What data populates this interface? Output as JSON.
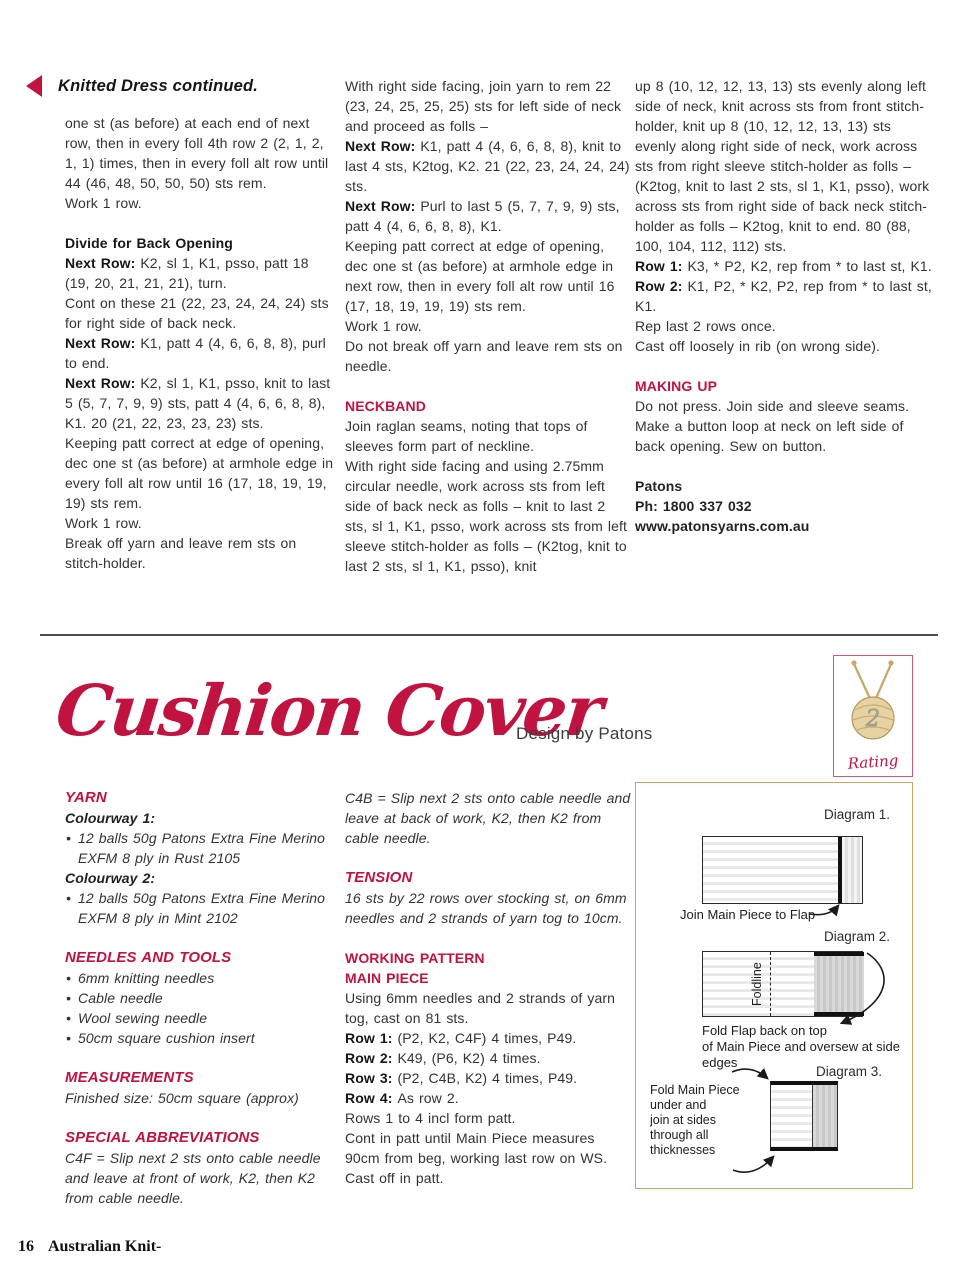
{
  "colors": {
    "accent_red": "#c01340",
    "diagram_border_tan": "#c9a566",
    "body_text": "#333333"
  },
  "header": {
    "continued_heading": "Knitted Dress continued."
  },
  "knitted_dress": {
    "col1": [
      {
        "name": "body-paragraph",
        "text": "one st (as before) at each end of next row, then in every foll 4th row 2 (2, 1, 2, 1, 1) times, then in every foll alt row until 44 (46, 48, 50, 50, 50) sts rem."
      },
      {
        "name": "body-paragraph",
        "text": "Work 1 row."
      },
      {
        "name": "subheading",
        "class": "hblack gap",
        "text": "Divide for Back Opening"
      },
      {
        "name": "body-paragraph",
        "label": "Next Row:",
        "text": "K2, sl 1, K1, psso, patt 18 (19, 20, 21, 21, 21), turn."
      },
      {
        "name": "body-paragraph",
        "text": "Cont on these 21 (22, 23, 24, 24, 24) sts for right side of back neck."
      },
      {
        "name": "body-paragraph",
        "label": "Next Row:",
        "text": "K1, patt 4 (4, 6, 6, 8, 8), purl to end."
      },
      {
        "name": "body-paragraph",
        "label": "Next Row:",
        "text": "K2, sl 1, K1, psso, knit to last 5 (5, 7, 7, 9, 9) sts, patt 4 (4, 6, 6, 8, 8), K1. 20 (21, 22, 23, 23, 23) sts."
      },
      {
        "name": "body-paragraph",
        "text": "Keeping patt correct at edge of opening, dec one st (as before) at armhole edge in every foll alt row until 16 (17, 18, 19, 19, 19) sts rem."
      },
      {
        "name": "body-paragraph",
        "text": "Work 1 row."
      },
      {
        "name": "body-paragraph",
        "text": "Break off yarn and leave rem sts on stitch-holder."
      }
    ],
    "col2": [
      {
        "name": "body-paragraph",
        "text": "With right side facing, join yarn to rem 22 (23, 24, 25, 25, 25) sts for left side of neck and proceed as folls –"
      },
      {
        "name": "body-paragraph",
        "label": "Next Row:",
        "text": "K1, patt 4 (4, 6, 6, 8, 8), knit to last 4 sts, K2tog, K2. 21 (22, 23, 24, 24, 24) sts."
      },
      {
        "name": "body-paragraph",
        "label": "Next Row:",
        "text": "Purl to last 5 (5, 7, 7, 9, 9) sts, patt 4 (4, 6, 6, 8, 8), K1."
      },
      {
        "name": "body-paragraph",
        "text": "Keeping patt correct at edge of opening, dec one st (as before) at armhole edge in next row, then in every foll alt row until 16 (17, 18, 19, 19, 19) sts rem."
      },
      {
        "name": "body-paragraph",
        "text": "Work 1 row."
      },
      {
        "name": "body-paragraph",
        "text": "Do not break off yarn and leave rem sts on needle."
      },
      {
        "name": "section-heading",
        "class": "hred gap",
        "text": "NECKBAND"
      },
      {
        "name": "body-paragraph",
        "text": "Join raglan seams, noting that tops of sleeves form part of neckline."
      },
      {
        "name": "body-paragraph",
        "text": "With right side facing and using 2.75mm circular needle, work across sts from left side of back neck as folls – knit to last 2 sts, sl 1, K1, psso, work across sts from left sleeve stitch-holder as folls – (K2tog, knit to last 2 sts, sl 1, K1, psso), knit"
      }
    ],
    "col3": [
      {
        "name": "body-paragraph",
        "text": "up 8 (10, 12, 12, 13, 13) sts evenly along left side of neck, knit across sts from front stitch-holder, knit up 8 (10, 12, 12, 13, 13) sts evenly along right side of neck, work across sts from right sleeve stitch-holder as folls – (K2tog, knit to last 2 sts, sl 1, K1, psso), work across sts from right side of back neck stitch-holder as folls – K2tog, knit to end. 80 (88, 100, 104, 112, 112) sts."
      },
      {
        "name": "body-paragraph",
        "label": "Row 1:",
        "text": "K3, * P2, K2, rep from * to last st, K1."
      },
      {
        "name": "body-paragraph",
        "label": "Row 2:",
        "text": "K1, P2, * K2, P2, rep from * to last st, K1."
      },
      {
        "name": "body-paragraph",
        "text": "Rep last 2 rows once."
      },
      {
        "name": "body-paragraph",
        "text": "Cast off loosely in rib (on wrong side)."
      },
      {
        "name": "section-heading",
        "class": "hred gap",
        "text": "MAKING UP"
      },
      {
        "name": "body-paragraph",
        "text": "Do not press. Join side and sleeve seams. Make a button loop at neck on left side of back opening. Sew on button."
      },
      {
        "name": "contact-brand",
        "class": "b gap",
        "text": "Patons"
      },
      {
        "name": "contact-phone",
        "class": "b",
        "text": "Ph: 1800 337 032"
      },
      {
        "name": "contact-url",
        "class": "b",
        "text": "www.patonsyarns.com.au"
      }
    ]
  },
  "title_section": {
    "title": "Cushion Cover",
    "byline": "Design by Patons",
    "rating": {
      "value": "2",
      "label": "Rating"
    }
  },
  "cushion_cover": {
    "col1": [
      {
        "name": "section-heading",
        "class": "hredi",
        "text": "YARN"
      },
      {
        "name": "subheading",
        "class": "bit",
        "text": "Colourway 1:"
      },
      {
        "name": "bullet-item",
        "class": "bullet it",
        "text": "12 balls 50g Patons Extra Fine Merino EXFM 8 ply in Rust 2105"
      },
      {
        "name": "subheading",
        "class": "bit",
        "text": "Colourway 2:"
      },
      {
        "name": "bullet-item",
        "class": "bullet it",
        "text": "12 balls 50g Patons Extra Fine Merino EXFM 8 ply in Mint 2102"
      },
      {
        "name": "section-heading",
        "class": "hredi gap",
        "text": "NEEDLES AND TOOLS"
      },
      {
        "name": "bullet-item",
        "class": "bullet it",
        "text": "6mm knitting needles"
      },
      {
        "name": "bullet-item",
        "class": "bullet it",
        "text": "Cable needle"
      },
      {
        "name": "bullet-item",
        "class": "bullet it",
        "text": "Wool sewing needle"
      },
      {
        "name": "bullet-item",
        "class": "bullet it",
        "text": "50cm square cushion insert"
      },
      {
        "name": "section-heading",
        "class": "hredi gap",
        "text": "MEASUREMENTS"
      },
      {
        "name": "body-paragraph",
        "class": "it",
        "text": "Finished size: 50cm square (approx)"
      },
      {
        "name": "section-heading",
        "class": "hredi gap",
        "text": "SPECIAL ABBREVIATIONS"
      },
      {
        "name": "body-paragraph",
        "class": "it",
        "text": "C4F = Slip next 2 sts onto cable needle and leave at front of work, K2, then K2 from cable needle."
      }
    ],
    "col2": [
      {
        "name": "body-paragraph",
        "class": "it",
        "text": "C4B = Slip next 2 sts onto cable needle and leave at back of work, K2, then K2 from cable needle."
      },
      {
        "name": "section-heading",
        "class": "hredi gap",
        "text": "TENSION"
      },
      {
        "name": "body-paragraph",
        "class": "it",
        "text": "16 sts by 22 rows over stocking st, on 6mm needles and 2 strands of yarn tog to 10cm."
      },
      {
        "name": "section-heading",
        "class": "hred gap",
        "text": "WORKING PATTERN"
      },
      {
        "name": "section-heading",
        "class": "hred",
        "text": "MAIN PIECE"
      },
      {
        "name": "body-paragraph",
        "text": "Using 6mm needles and 2 strands of yarn tog, cast on 81 sts."
      },
      {
        "name": "body-paragraph",
        "label": "Row 1:",
        "text": "(P2, K2, C4F) 4 times, P49."
      },
      {
        "name": "body-paragraph",
        "label": "Row 2:",
        "text": "K49, (P6, K2) 4 times."
      },
      {
        "name": "body-paragraph",
        "label": "Row 3:",
        "text": "(P2, C4B, K2) 4 times, P49."
      },
      {
        "name": "body-paragraph",
        "label": "Row 4:",
        "text": "As row 2."
      },
      {
        "name": "body-paragraph",
        "text": "Rows 1 to 4 incl form patt."
      },
      {
        "name": "body-paragraph",
        "text": "Cont in patt until Main Piece measures 90cm from beg, working last row on WS. Cast off in patt."
      }
    ]
  },
  "diagrams": {
    "d1": {
      "label": "Diagram 1.",
      "caption": "Join Main Piece to Flap"
    },
    "d2": {
      "label": "Diagram 2.",
      "foldline": "Foldline",
      "caption_line1": "Fold Flap back on top",
      "caption_line2": "of Main Piece and oversew at side edges"
    },
    "d3": {
      "label": "Diagram 3.",
      "note_lines": [
        {
          "name": "diagram-note-line",
          "text": "Fold Main Piece"
        },
        {
          "name": "diagram-note-line",
          "text": "under and"
        },
        {
          "name": "diagram-note-line",
          "text": "join at sides"
        },
        {
          "name": "diagram-note-line",
          "text": "through all"
        },
        {
          "name": "diagram-note-line",
          "text": "thicknesses"
        }
      ]
    }
  },
  "footer": {
    "page_number": "16",
    "magazine": "Australian Knit-"
  }
}
